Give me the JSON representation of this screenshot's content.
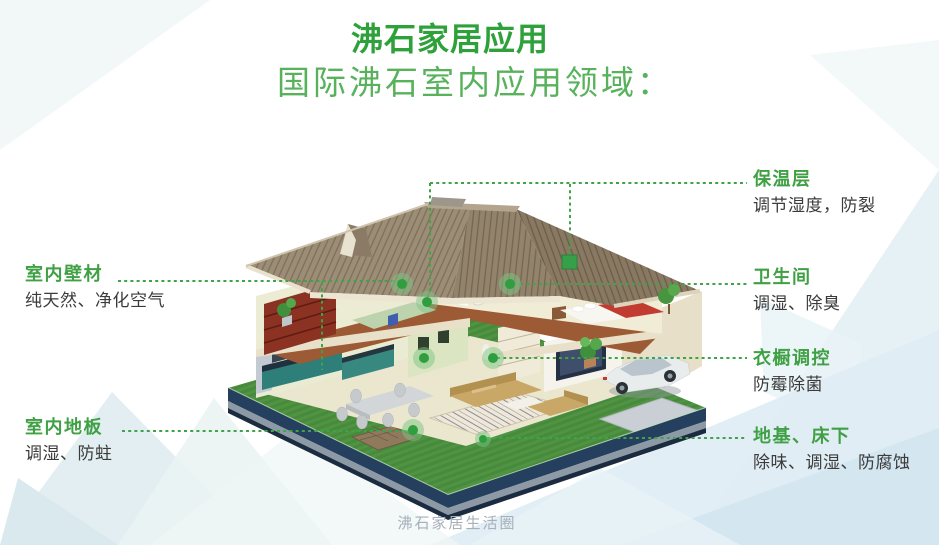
{
  "header": {
    "title": "沸石家居应用",
    "subtitle": "国际沸石室内应用领域："
  },
  "annotations": {
    "left": [
      {
        "id": "interior-wall",
        "title": "室内壁材",
        "desc": "纯天然、净化空气"
      },
      {
        "id": "interior-floor",
        "title": "室内地板",
        "desc": "调湿、防蛀"
      }
    ],
    "right": [
      {
        "id": "insulation-layer",
        "title": "保温层",
        "desc": "调节湿度，防裂"
      },
      {
        "id": "bathroom",
        "title": "卫生间",
        "desc": "调湿、除臭"
      },
      {
        "id": "wardrobe-control",
        "title": "衣橱调控",
        "desc": "防霉除菌"
      },
      {
        "id": "foundation-underbed",
        "title": "地基、床下",
        "desc": "除味、调湿、防腐蚀"
      }
    ]
  },
  "footer": {
    "text": "沸石家居生活圈"
  },
  "colors": {
    "title_green": "#2ea13a",
    "subtitle_green": "#58b25c",
    "label_green": "#3fa044",
    "connector_green": "#3fa449",
    "marker_green": "#2f9e3f",
    "desc_text": "#3b3b3b",
    "footer_gray": "#a6afba",
    "lawn_green": "#4f9343",
    "base_navy": "#24405e",
    "roof_brown": "#9c8d77"
  },
  "house": {
    "markers": [
      "roof-insulation-square-marker",
      "wall-material-marker",
      "attic-interior-marker",
      "bathroom-marker",
      "ground-wall-marker",
      "wardrobe-marker",
      "floor-marker",
      "foundation-marker"
    ]
  }
}
